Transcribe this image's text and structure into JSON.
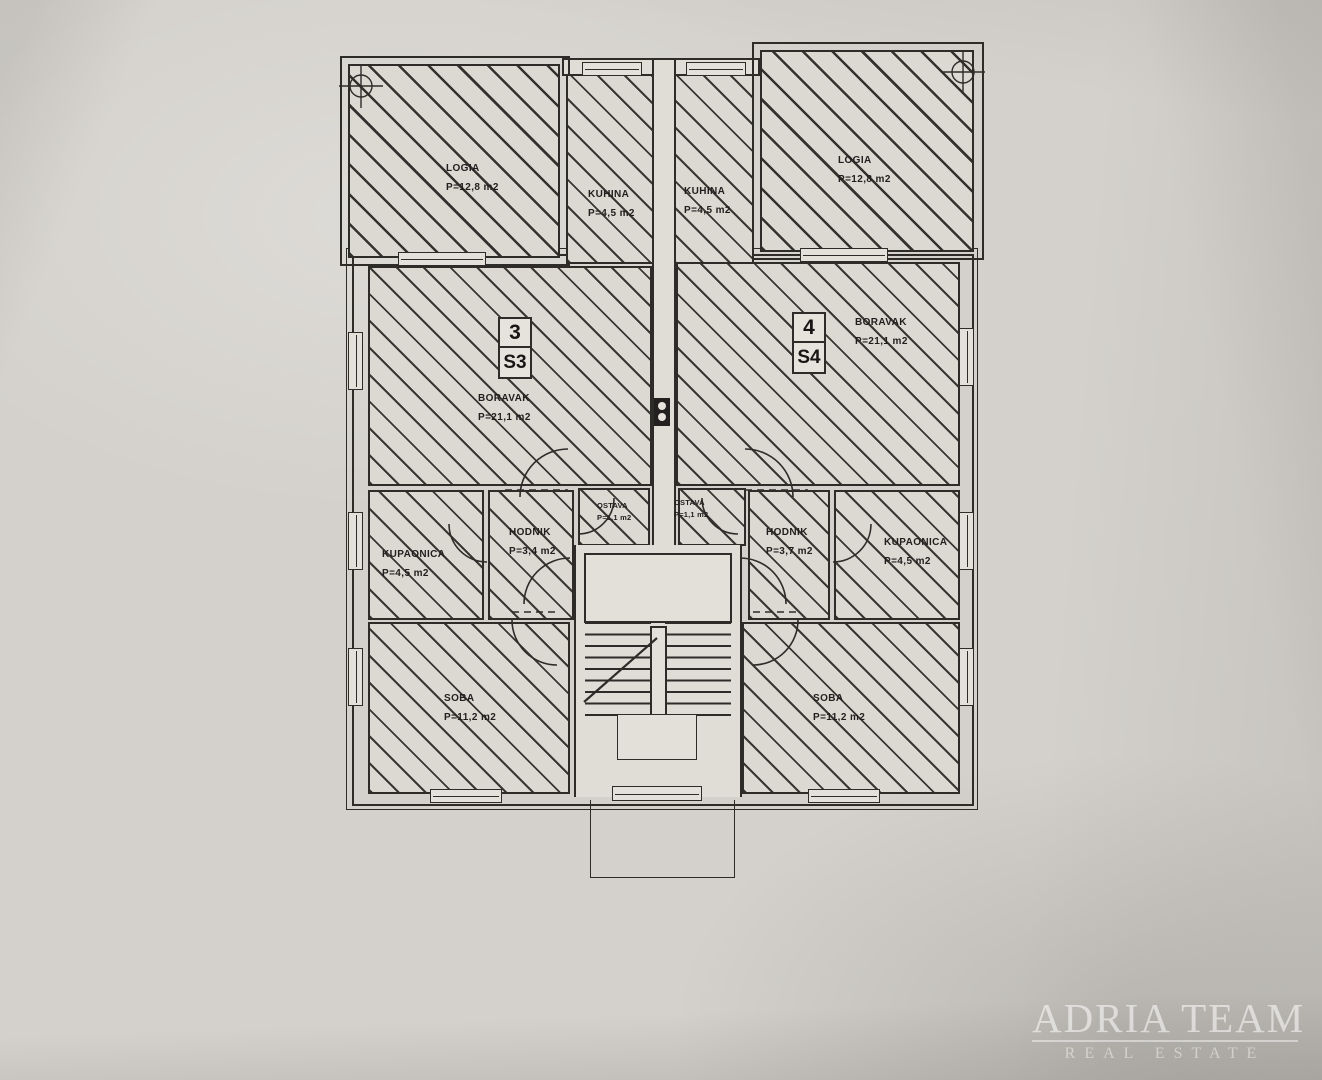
{
  "plan": {
    "title_note": "floor plan with two apartments",
    "rooms": [
      {
        "id": "loggia-left",
        "name": "LOGIA",
        "area": "P=12,8 m2"
      },
      {
        "id": "kuhina-left",
        "name": "KUHINA",
        "area": "P=4,5 m2"
      },
      {
        "id": "kuhina-right",
        "name": "KUHINA",
        "area": "P=4,5 m2"
      },
      {
        "id": "loggia-right",
        "name": "LOGIA",
        "area": "P=12,8 m2"
      },
      {
        "id": "boravak-left",
        "name": "BORAVAK",
        "area": "P=21,1 m2"
      },
      {
        "id": "boravak-right",
        "name": "BORAVAK",
        "area": "P=21,1 m2"
      },
      {
        "id": "ostava-left",
        "name": "OSTAVA",
        "area": "P=1,1 m2"
      },
      {
        "id": "ostava-right",
        "name": "OSTAVA",
        "area": "P=1,1 m2"
      },
      {
        "id": "kupaonica-left",
        "name": "KUPAONICA",
        "area": "P=4,5 m2"
      },
      {
        "id": "hodnik-left",
        "name": "HODNIK",
        "area": "P=3,4 m2"
      },
      {
        "id": "hodnik-right",
        "name": "HODNIK",
        "area": "P=3,7 m2"
      },
      {
        "id": "kupaonica-right",
        "name": "KUPAONICA",
        "area": "P=4,5 m2"
      },
      {
        "id": "soba-left",
        "name": "SOBA",
        "area": "P=11,2 m2"
      },
      {
        "id": "soba-right",
        "name": "SOBA",
        "area": "P=11,2 m2"
      }
    ],
    "units": [
      {
        "number": "3",
        "code": "S3"
      },
      {
        "number": "4",
        "code": "S4"
      }
    ],
    "colors": {
      "ink": "#2e2c29",
      "paper": "#d4d1cc",
      "floor": "#dcd9d3"
    }
  },
  "watermark": {
    "line1": "ADRIA TEAM",
    "line2": "REAL ESTATE"
  }
}
